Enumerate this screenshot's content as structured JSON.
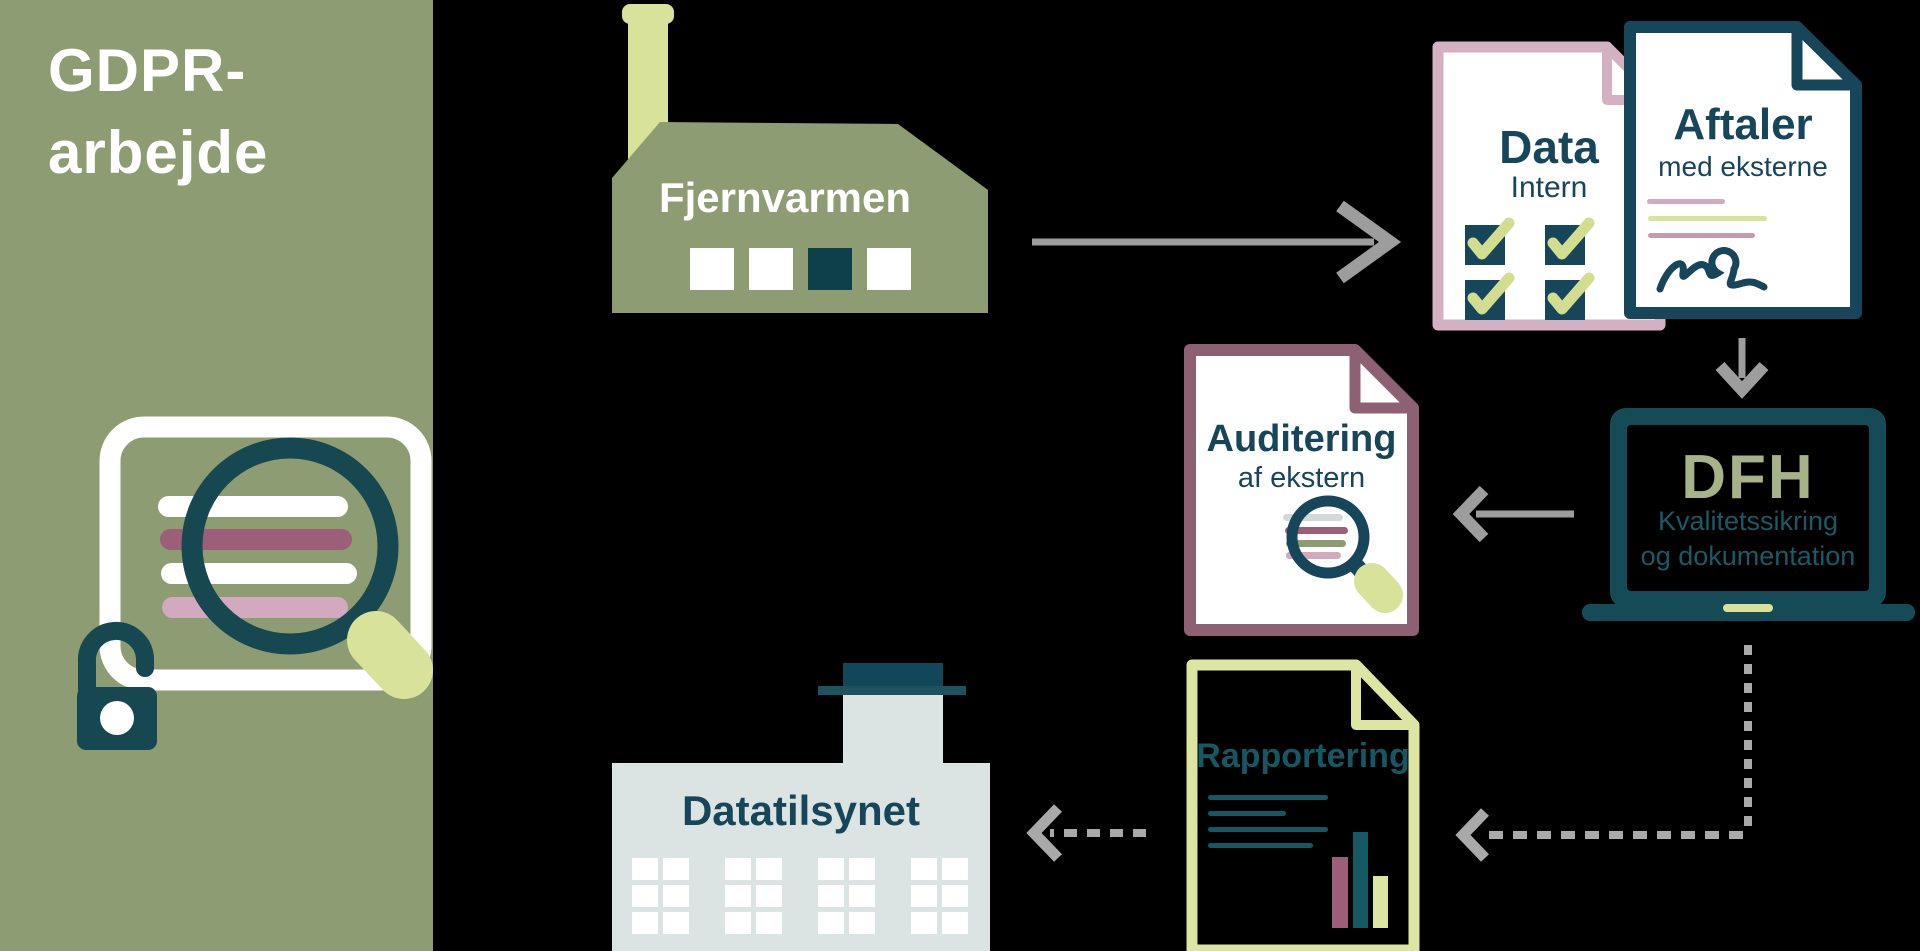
{
  "title": {
    "line1": "GDPR-",
    "line2": "arbejde"
  },
  "nodes": {
    "fjernvarmen": {
      "label": "Fjernvarmen",
      "icon": "factory-building"
    },
    "data_intern": {
      "title": "Data",
      "subtitle": "Intern",
      "icon": "checklist-document"
    },
    "aftaler": {
      "title": "Aftaler",
      "subtitle": "med eksterne",
      "icon": "signed-contract-document"
    },
    "dfh": {
      "title": "DFH",
      "subtitle_line1": "Kvalitetssikring",
      "subtitle_line2": "og dokumentation",
      "icon": "laptop"
    },
    "auditering": {
      "title": "Auditering",
      "subtitle": "af ekstern",
      "icon": "magnifier-document"
    },
    "rapportering": {
      "title": "Rapportering",
      "icon": "report-bar-chart-document"
    },
    "datatilsynet": {
      "label": "Datatilsynet",
      "icon": "authority-building"
    }
  },
  "edges": [
    {
      "from": "fjernvarmen",
      "to": "data_intern",
      "style": "solid"
    },
    {
      "from": "aftaler",
      "to": "dfh",
      "style": "solid"
    },
    {
      "from": "dfh",
      "to": "auditering",
      "style": "solid"
    },
    {
      "from": "dfh",
      "to": "rapportering",
      "style": "dashed"
    },
    {
      "from": "rapportering",
      "to": "datatilsynet",
      "style": "dashed"
    }
  ],
  "palette": {
    "sage_green": "#8d9c72",
    "light_green": "#d9e29a",
    "dark_teal": "#154a57",
    "teal_text": "#17455a",
    "plum": "#8d6073",
    "pink_border": "#d4b1c2",
    "mauve": "#9b5f79",
    "light_pink": "#d2a9be",
    "arrow_gray": "#9d9d9d",
    "building_gray": "#dce3e3",
    "dfh_olive": "#a8b289",
    "background": "#000000"
  }
}
